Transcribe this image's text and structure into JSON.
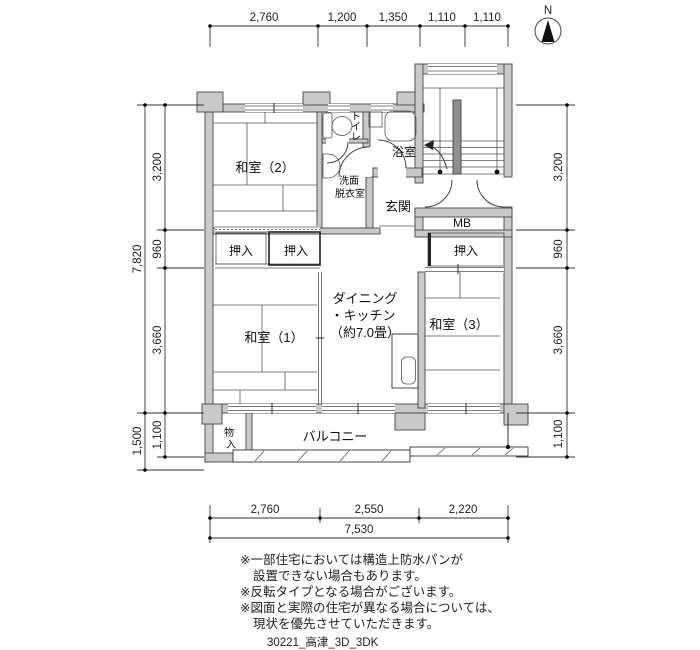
{
  "north_label": "N",
  "dims": {
    "top": [
      "2,760",
      "1,200",
      "1,350",
      "1,110",
      "1,110"
    ],
    "left_total": "7,820",
    "left_segments": [
      "3,200",
      "960",
      "3,660"
    ],
    "left_outer_bottom": "1,500",
    "left_inner_bottom": "1,100",
    "right_segments": [
      "3,200",
      "960",
      "3,660",
      "1,100"
    ],
    "bottom_segments": [
      "2,760",
      "2,550",
      "2,220"
    ],
    "bottom_total": "7,530"
  },
  "rooms": {
    "washitsu2": "和室（2）",
    "washitsu1": "和室（1）",
    "washitsu3": "和室（3）",
    "toilet_chars": [
      "ト",
      "イ",
      "レ"
    ],
    "bath": "浴室",
    "washroom_lines": [
      "洗面",
      "脱衣室"
    ],
    "genkan": "玄関",
    "meter_box": "MB",
    "closet1": "押入",
    "closet2": "押入",
    "closet3": "押入",
    "dk_lines": [
      "ダイニング",
      "・キッチン",
      "（約7.0畳）"
    ],
    "balcony": "バルコニー",
    "storage_chars": [
      "物",
      "入"
    ]
  },
  "notes": [
    "※一部住宅においては構造上防水パンが",
    "設置できない場合もあります。",
    "※反転タイプとなる場合がございます。",
    "※図面と実際の住宅が異なる場合については、",
    "現状を優先させていただきます。"
  ],
  "footer_code": "30221_高津_3D_3DK",
  "colors": {
    "wall": "#c9c9c9",
    "banister": "#8f8f8f",
    "line": "#333333"
  }
}
